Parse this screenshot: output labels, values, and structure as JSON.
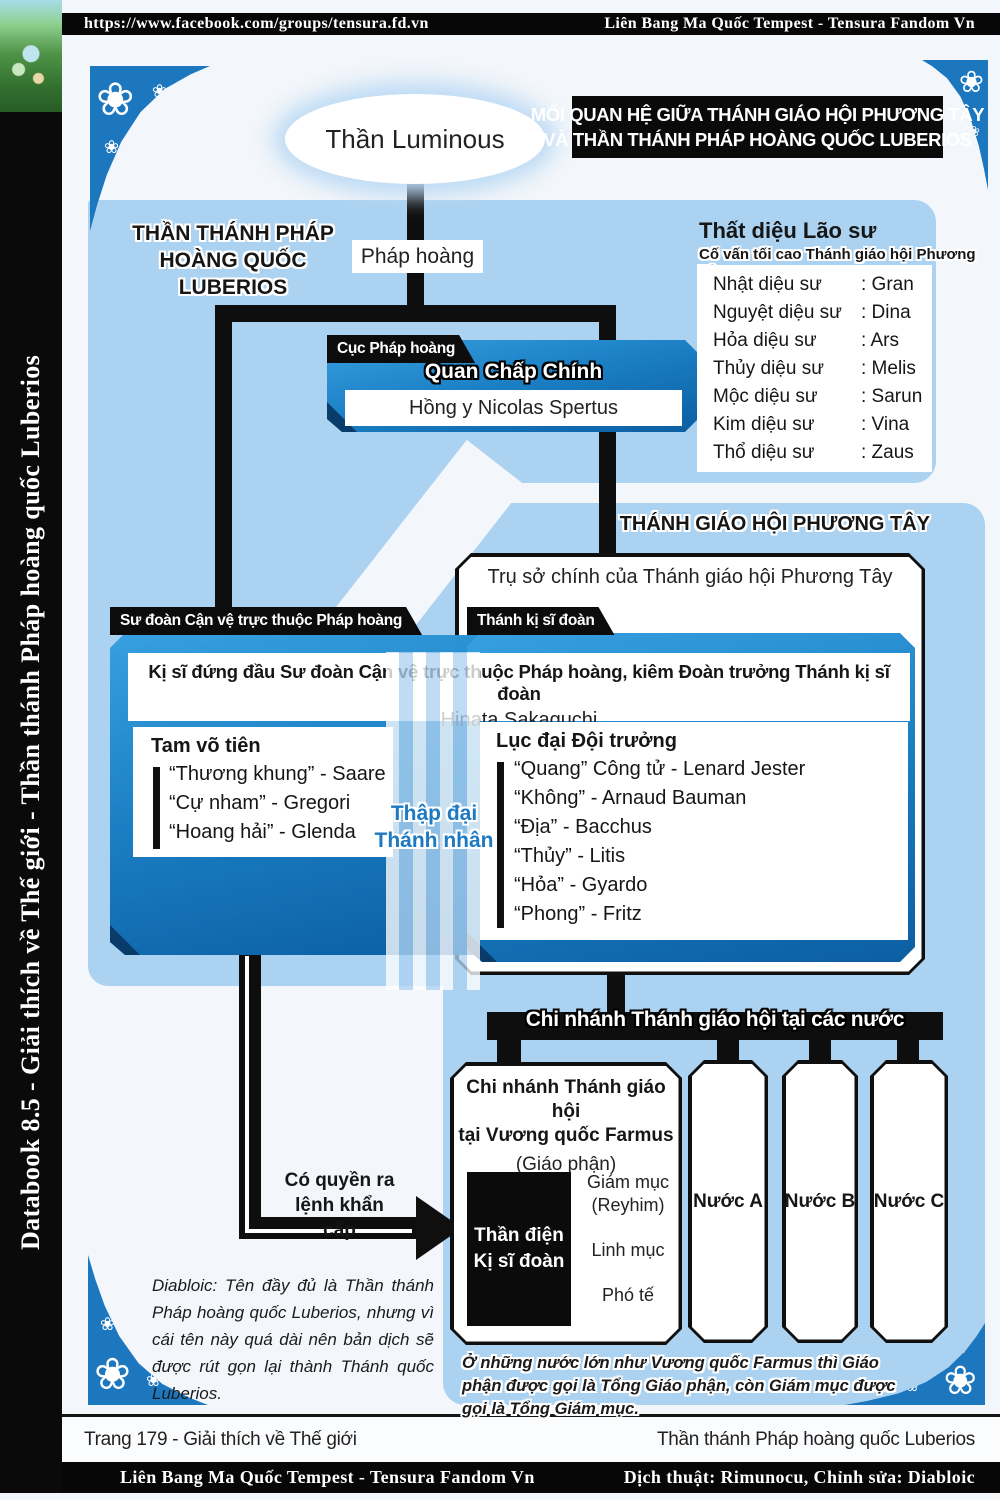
{
  "colors": {
    "accent_blue": "#1b7fc4",
    "panel_blue": "#abd2f1",
    "black": "#0c0c0c",
    "white": "#ffffff"
  },
  "icons": {
    "flower": "❀"
  },
  "top_bar": {
    "url": "https://www.facebook.com/groups/tensura.fd.vn",
    "community": "Liên Bang Ma Quốc Tempest - Tensura Fandom Vn"
  },
  "sidebar": {
    "text": "Databook 8.5 - Giải thích về Thế giới - Thần thánh Pháp hoàng quốc Luberios"
  },
  "header": {
    "deity": "Thần Luminous",
    "title_line1": "MỐI QUAN HỆ GIỮA THÁNH GIÁO HỘI PHƯƠNG TÂY",
    "title_line2": "VÀ THẦN THÁNH PHÁP HOÀNG QUỐC LUBERIOS"
  },
  "luberios": {
    "heading_line1": "THẦN THÁNH PHÁP",
    "heading_line2": "HOÀNG QUỐC LUBERIOS",
    "pope_label": "Pháp hoàng"
  },
  "advisors": {
    "title": "Thất diệu Lão sư",
    "subtitle": "Cố vấn tối cao Thánh giáo hội Phương Tây",
    "rows": [
      {
        "role": "Nhật diệu sư",
        "name": ": Gran"
      },
      {
        "role": "Nguyệt diệu sư",
        "name": ": Dina"
      },
      {
        "role": "Hỏa diệu sư",
        "name": ": Ars"
      },
      {
        "role": "Thủy diệu sư",
        "name": ": Melis"
      },
      {
        "role": "Mộc diệu sư",
        "name": ": Sarun"
      },
      {
        "role": "Kim diệu sư",
        "name": ": Vina"
      },
      {
        "role": "Thổ diệu sư",
        "name": ": Zaus"
      }
    ]
  },
  "executive": {
    "tag": "Cục Pháp hoàng",
    "title": "Quan Chấp Chính",
    "person": "Hồng y Nicolas Spertus"
  },
  "church": {
    "heading": "THÁNH GIÁO HỘI PHƯƠNG TÂY",
    "hq": "Trụ sở chính của Thánh giáo hội Phương Tây"
  },
  "guard_division": {
    "tag": "Sư đoàn Cận vệ trực thuộc Pháp hoàng"
  },
  "holy_knights": {
    "tag": "Thánh kị sĩ đoàn"
  },
  "hinata": {
    "role_line": "Kị sĩ đứng đầu Sư đoàn Cận vệ trực thuộc Pháp hoàng, kiêm Đoàn trưởng Thánh kị sĩ đoàn",
    "name": "Hinata Sakaguchi"
  },
  "three_martial": {
    "title": "Tam võ tiên",
    "items": [
      "“Thương khung” - Saare",
      "“Cự nham” - Gregori",
      "“Hoang hải” - Glenda"
    ]
  },
  "ten_saints": {
    "line1": "Thập đại",
    "line2": "Thánh nhân"
  },
  "six_captains": {
    "title": "Lục đại Đội trưởng",
    "items": [
      "“Quang” Công tử - Lenard Jester",
      "“Không” - Arnaud Bauman",
      "“Địa” - Bacchus",
      "“Thủy” - Litis",
      "“Hỏa” - Gyardo",
      "“Phong” - Fritz"
    ]
  },
  "branches": {
    "bar": "Chi nhánh Thánh giáo hội tại các nước",
    "farmus": {
      "title_line1": "Chi nhánh Thánh giáo hội",
      "title_line2": "tại Vương quốc Farmus",
      "subtitle": "(Giáo phận)",
      "temple_line1": "Thần điện",
      "temple_line2": "Kị sĩ đoàn",
      "bishop": "Giám mục",
      "bishop_name": "(Reyhim)",
      "priest": "Linh mục",
      "deacon": "Phó tế"
    },
    "others": [
      "Nước A",
      "Nước B",
      "Nước C"
    ]
  },
  "emergency": {
    "line1": "Có quyền ra",
    "line2": "lệnh khẩn cấp"
  },
  "notes": {
    "translator": "Diabloic: Tên đầy đủ là Thần thánh Pháp hoàng quốc Luberios, nhưng vì cái tên này quá dài nên bản dịch sẽ được rút gọn lại thành Thánh quốc Luberios.",
    "bottom": "Ở những nước lớn như Vương quốc Farmus thì Giáo phận được gọi là Tổng Giáo phận, còn Giám mục được gọi là Tổng Giám mục."
  },
  "footer": {
    "page": "Trang 179 - Giải thích về Thế giới",
    "right": "Thần thánh Pháp hoàng quốc Luberios",
    "bar_left": "Liên Bang Ma Quốc Tempest - Tensura Fandom Vn",
    "bar_right": "Dịch thuật: Rimunocu, Chỉnh sửa: Diabloic"
  }
}
